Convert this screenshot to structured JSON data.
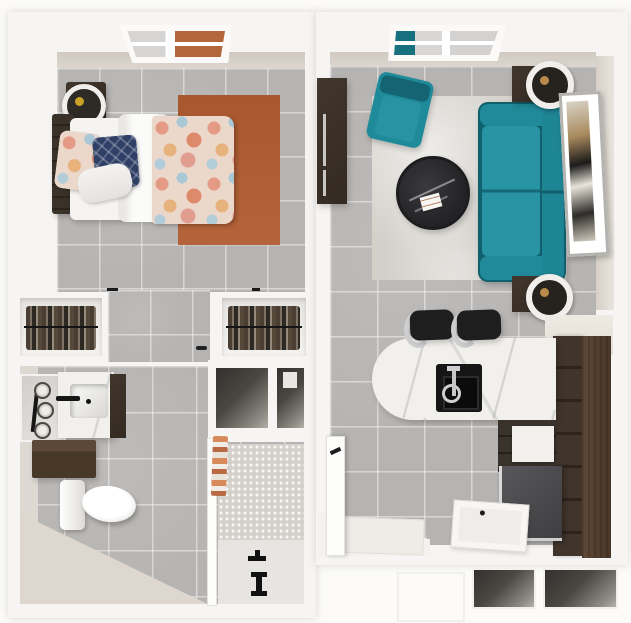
{
  "meta": {
    "description": "3D top-down rendered floor plan of a studio apartment"
  },
  "palette": {
    "wall_white": "#f7f5f3",
    "wall_cream": "#d8d2ca",
    "tile_grey": "#b6b4b2",
    "rug_orange": "#ad5a31",
    "sofa_teal": "#1f8593",
    "dark_wood": "#3b3128",
    "kitchen_wood": "#5c4534",
    "marble_white": "#f2f0ec",
    "navy_pillow": "#2f3f66",
    "fixture_black": "#1b1b1b"
  },
  "rooms": {
    "bedroom": {
      "label": "Bedroom",
      "items": [
        "window",
        "single-bed",
        "floral-comforter",
        "white-duvet",
        "accent-pillows",
        "headboard",
        "nightstand",
        "table-lamp",
        "orange-area-rug",
        "tile-floor"
      ]
    },
    "closets": {
      "label": "Closets",
      "items": [
        "left-closet",
        "right-closet",
        "hanging-clothes",
        "hallway"
      ]
    },
    "bathroom": {
      "label": "Bathroom",
      "items": [
        "vanity-mirror",
        "sconce-lights",
        "marble-vanity",
        "sink-basin",
        "black-faucet",
        "floating-shelf",
        "toilet",
        "utility-niches",
        "glass-partition",
        "towel",
        "mosaic-shower-wall",
        "shower-floor",
        "shower-fixtures"
      ]
    },
    "living_room": {
      "label": "Living Room",
      "items": [
        "window",
        "teal-sofa",
        "teal-armchair",
        "round-coffee-table",
        "magazine",
        "area-rug",
        "media-cabinet",
        "side-table-top",
        "table-lamp-top",
        "side-table-bottom",
        "table-lamp-bottom",
        "wall-art"
      ]
    },
    "kitchen": {
      "label": "Kitchen",
      "items": [
        "marble-peninsula",
        "black-sink",
        "chrome-faucet",
        "bar-stools",
        "cream-counter",
        "tall-cabinets",
        "base-cabinet",
        "appliance",
        "open-doors",
        "entry-floor"
      ]
    },
    "entry": {
      "label": "Entry",
      "items": [
        "wall-recesses"
      ]
    }
  }
}
